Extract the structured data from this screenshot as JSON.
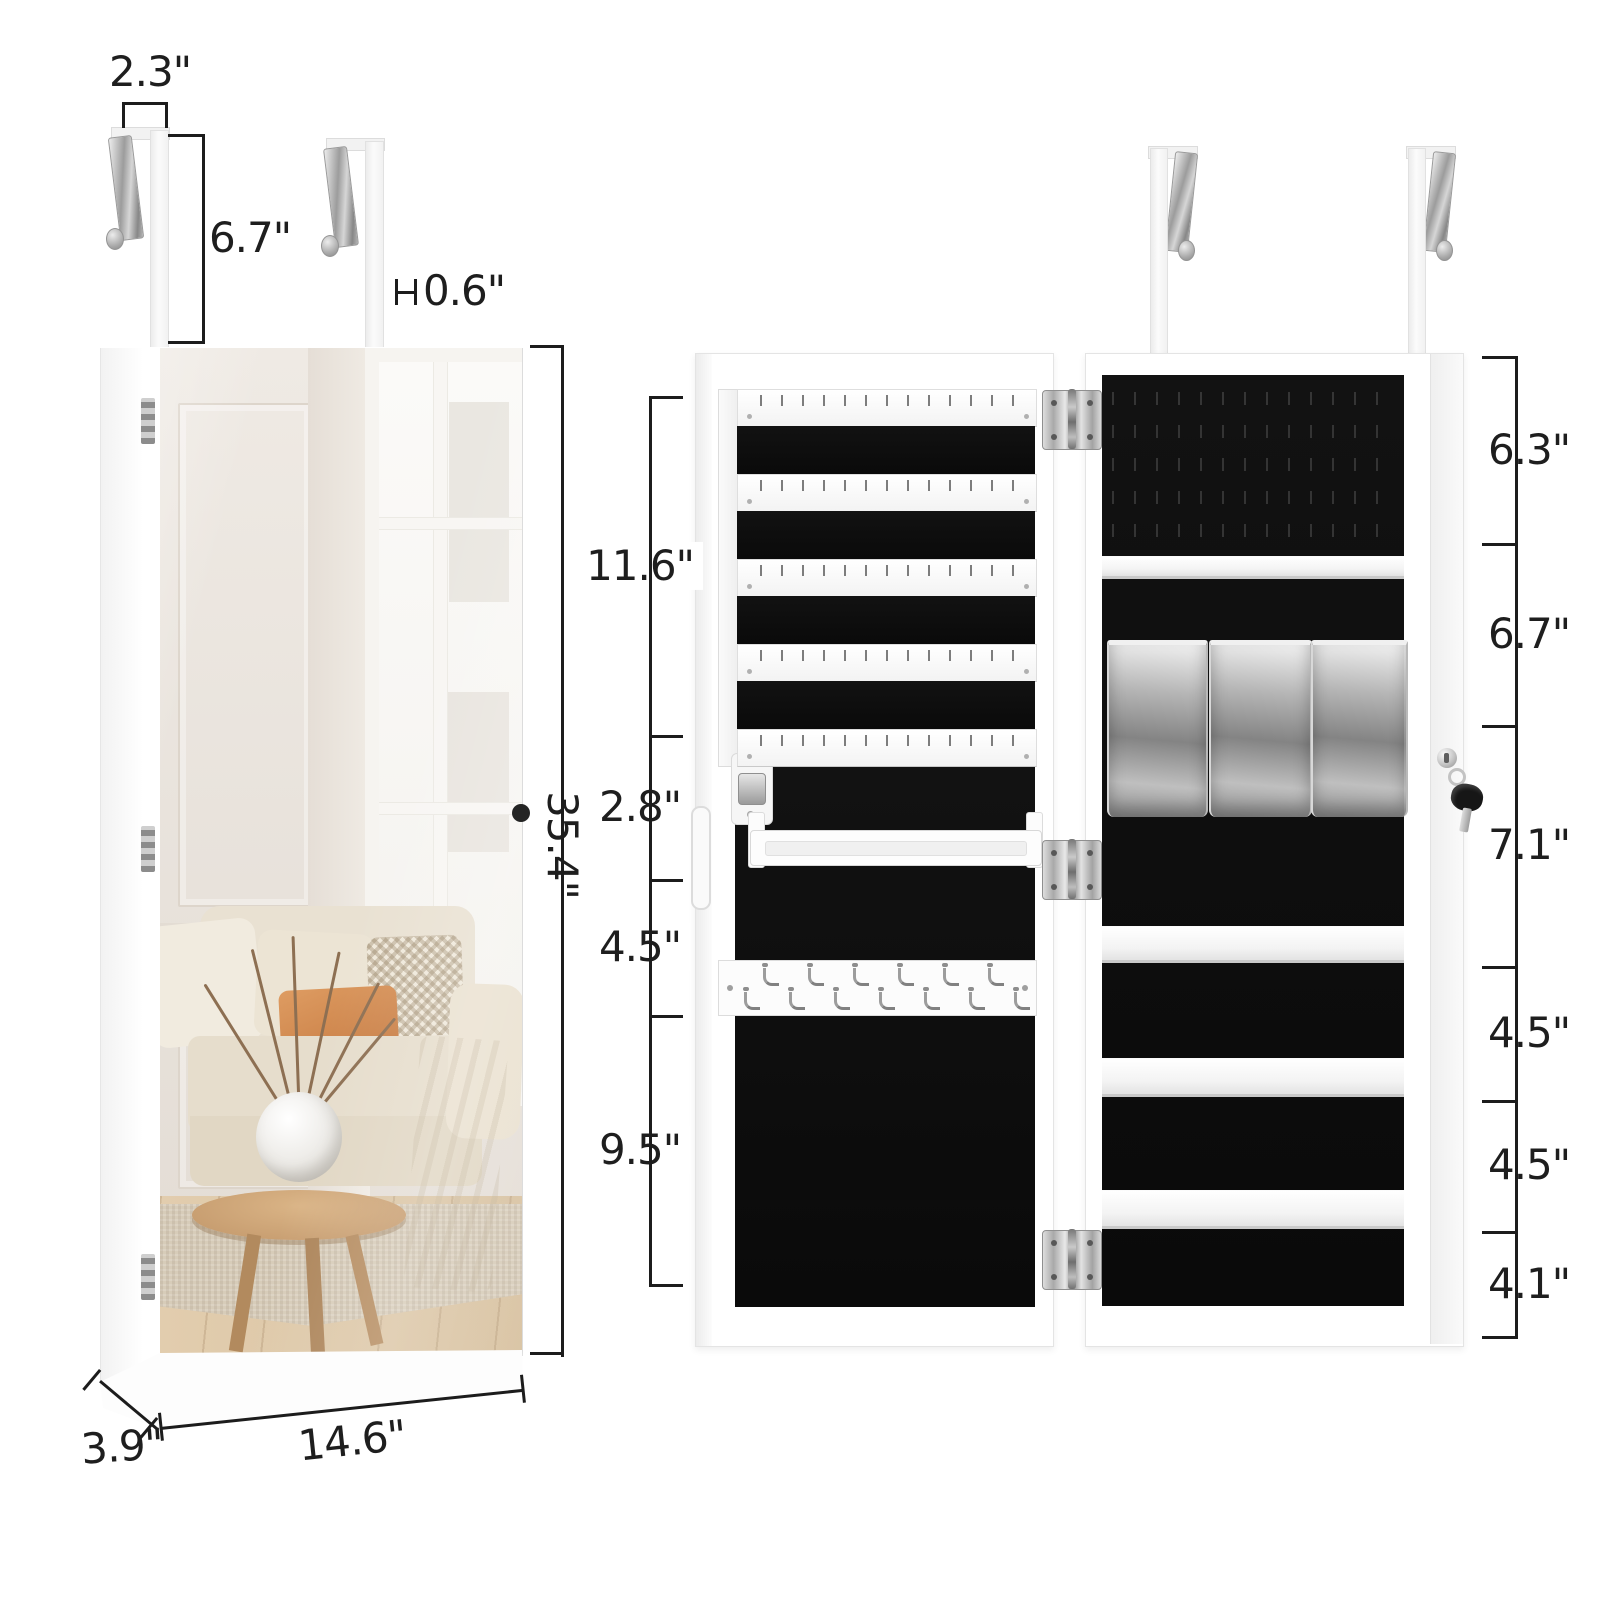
{
  "product": "over-the-door lockable jewelry cabinet with mirror",
  "figure_left": {
    "name": "closed cabinet front view with mirror",
    "dims": {
      "hook_width": "2.3\"",
      "hook_height": "6.7\"",
      "hook_thickness": "0.6\"",
      "cabinet_height": "35.4\"",
      "cabinet_depth": "3.9\"",
      "cabinet_width": "14.6\""
    }
  },
  "figure_right": {
    "name": "open cabinet interior view",
    "door_sections": [
      "11.6\"",
      "2.8\"",
      "4.5\"",
      "9.5\""
    ],
    "body_sections": [
      "6.3\"",
      "6.7\"",
      "7.1\"",
      "4.5\"",
      "4.5\"",
      "4.1\""
    ],
    "counts": {
      "earring_strips": 5,
      "necklace_hooks_top": 6,
      "necklace_hooks_bottom": 7,
      "storage_bins": 3,
      "shelf_ledges": 3,
      "ring_rows": 5,
      "hinges": 3,
      "over_door_hooks_per_unit": 2
    }
  },
  "colors": {
    "line": "#1c1c1c",
    "felt": "#0b0b0b",
    "cabinet": "#ffffff",
    "metal": "#b0b0b0",
    "wood": "#c89a6b"
  }
}
